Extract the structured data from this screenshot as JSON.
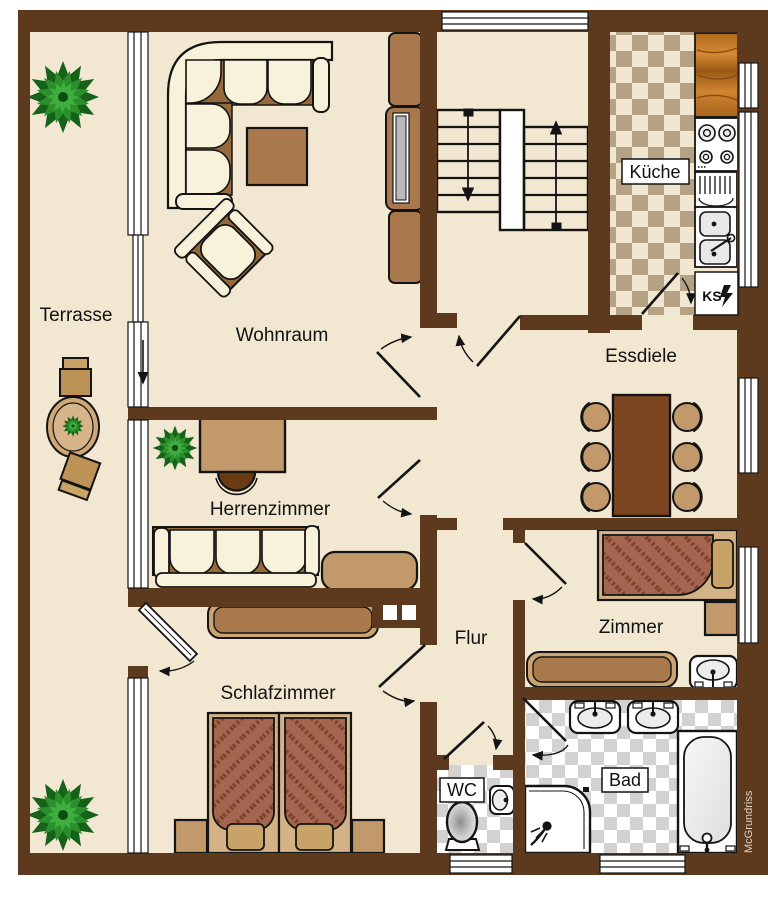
{
  "meta": {
    "type": "floor-plan",
    "watermark": "McGrundriss"
  },
  "rooms": {
    "terrasse": {
      "label": "Terrasse"
    },
    "wohnraum": {
      "label": "Wohnraum"
    },
    "kueche": {
      "label": "Küche"
    },
    "essdiele": {
      "label": "Essdiele"
    },
    "herrenzimmer": {
      "label": "Herrenzimmer"
    },
    "flur": {
      "label": "Flur"
    },
    "zimmer": {
      "label": "Zimmer"
    },
    "schlafzimmer": {
      "label": "Schlafzimmer"
    },
    "wc": {
      "label": "WC"
    },
    "bad": {
      "label": "Bad"
    }
  },
  "appliances": {
    "fridge_label": "KS"
  },
  "icons": [
    "tree-icon",
    "potted-plant-icon",
    "stairs-up-arrow-icon",
    "stairs-down-arrow-icon",
    "stove-icon",
    "kitchen-sink-icon",
    "fridge-lightning-icon",
    "door-swing-icon",
    "toilet-icon",
    "washbasin-icon",
    "bathtub-icon",
    "shower-icon",
    "bed-icon",
    "sofa-icon",
    "dining-table-icon",
    "desk-icon",
    "tv-cabinet-icon"
  ],
  "colors": {
    "wall": "#5d3a1d",
    "floor": "#f2e7d1",
    "cream": "#f8f2da",
    "tan": "#c2996b",
    "mid_brown": "#a9784d",
    "dark_brown": "#7a4520",
    "sofa_base": "#96693c",
    "bed_blanket": "#a5664f",
    "bed_stripe": "#7d3f2e",
    "kitchen_check": "#b5a183",
    "bath_check": "#d2d2d2",
    "wood": "#c87f2f",
    "plant_green": "#2b8f2b"
  }
}
